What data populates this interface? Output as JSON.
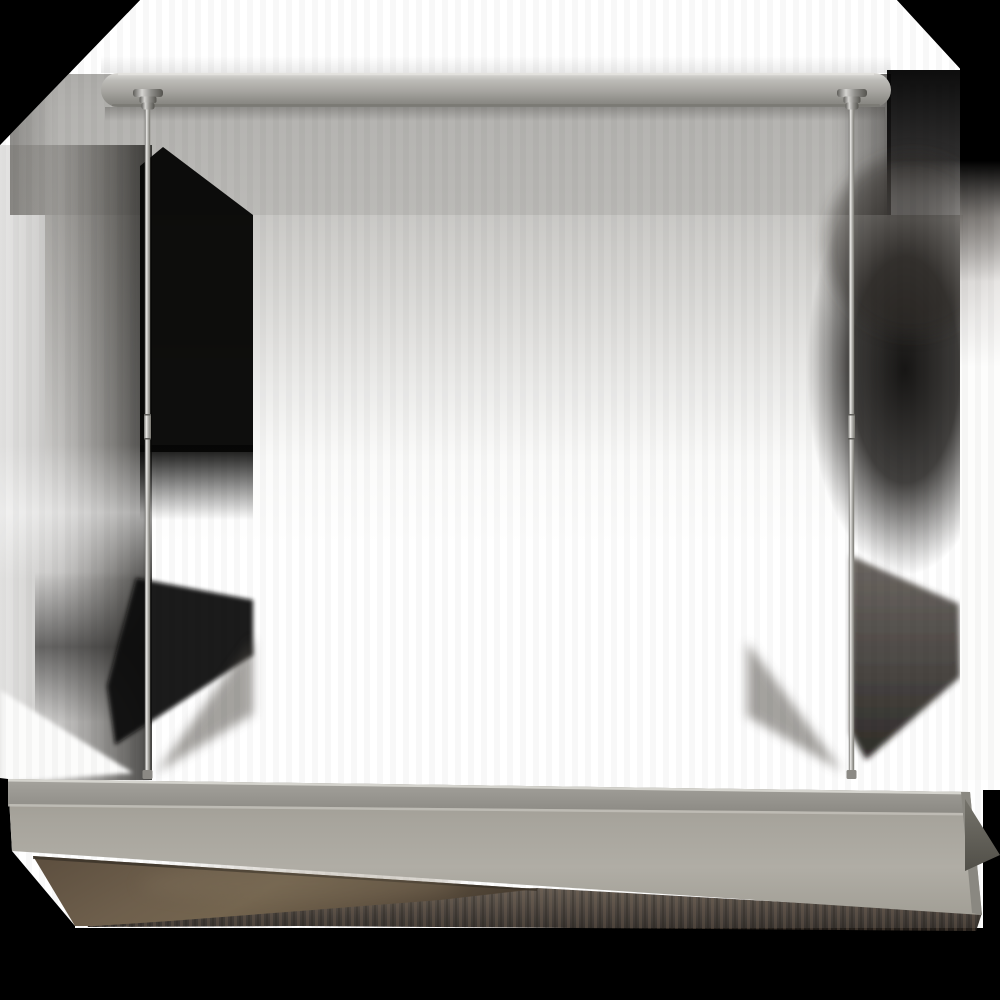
{
  "image": {
    "kind": "product-photo",
    "subject": "linear-suspension-chandelier",
    "width": 1000,
    "height": 1000
  },
  "palette": {
    "bg": "#000000",
    "backdrop_white": "#ffffff",
    "canopy_shadow_band": "#b4b3b0",
    "canopy_metal_light": "#dcdbd7",
    "canopy_metal_mid": "#a5a49f",
    "canopy_metal_dark": "#82817c",
    "rod_edge": "#6e6d69",
    "rod_highlight": "#f0efec",
    "hub_metal": "#8f8e8a",
    "shade_face": "#a9a69e",
    "shade_lip": "#8c8a84",
    "shade_crease": "#c2c0b9",
    "shade_right_facet": "#8a8881",
    "shade_right_flap": "#68665f",
    "bronze_underside": "#6e5f4c",
    "bronze_dark": "#4a3f32",
    "under_shadow": "#4a4038",
    "soft_shadow_dark": "#0e0d0c"
  },
  "parts": [
    "ceiling-canopy-bar",
    "canopy-hub-left",
    "canopy-hub-right",
    "suspension-rod-left",
    "suspension-rod-right",
    "rod-coupler-left",
    "rod-coupler-right",
    "rod-base-connector-left",
    "rod-base-connector-right",
    "shade-top-lip",
    "shade-front-face",
    "shade-underside-bronze",
    "shade-right-flap",
    "backdrop"
  ]
}
